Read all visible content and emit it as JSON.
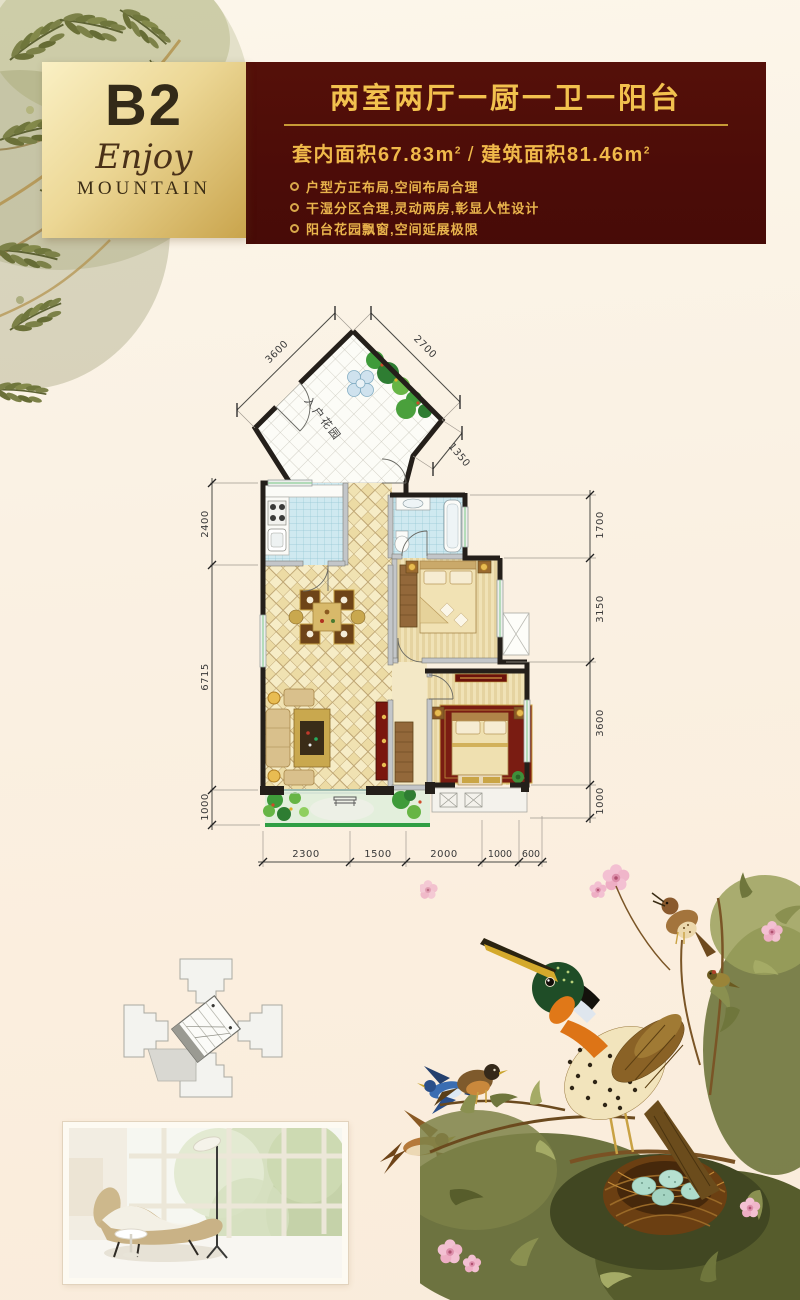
{
  "badge": {
    "unit": "B2",
    "subtitle_script": "Enjoy",
    "subtitle_caps": "MOUNTAIN"
  },
  "banner": {
    "title": "两室两厅一厨一卫一阳台",
    "area_left_label": "套内面积",
    "area_left_value": "67.83",
    "area_right_label": "建筑面积",
    "area_right_value": "81.46",
    "area_unit": "m",
    "area_sup": "2",
    "area_divider": "/",
    "bullets": [
      "户型方正布局,空间布局合理",
      "干湿分区合理,灵动两房,彰显人性设计",
      "阳台花园飘窗,空间延展极限"
    ]
  },
  "floorplan": {
    "room_label": "入户花园",
    "dims_top": [
      "3600",
      "2700",
      "1350"
    ],
    "dims_left": [
      "2400",
      "6715",
      "1000"
    ],
    "dims_right": [
      "1700",
      "3150",
      "3600",
      "1000"
    ],
    "dims_bottom": [
      "2300",
      "1500",
      "2000",
      "1000",
      "600"
    ]
  },
  "colors": {
    "accent_gold": "#d8a84a",
    "banner_maroon": "#4d0c08",
    "plan_wall": "#241f1a",
    "tile_blue": "#cfe9f0",
    "floor_beige": "#f2e3b8",
    "balcony_green": "#2f9e44",
    "egg_teal": "#aedccb"
  }
}
